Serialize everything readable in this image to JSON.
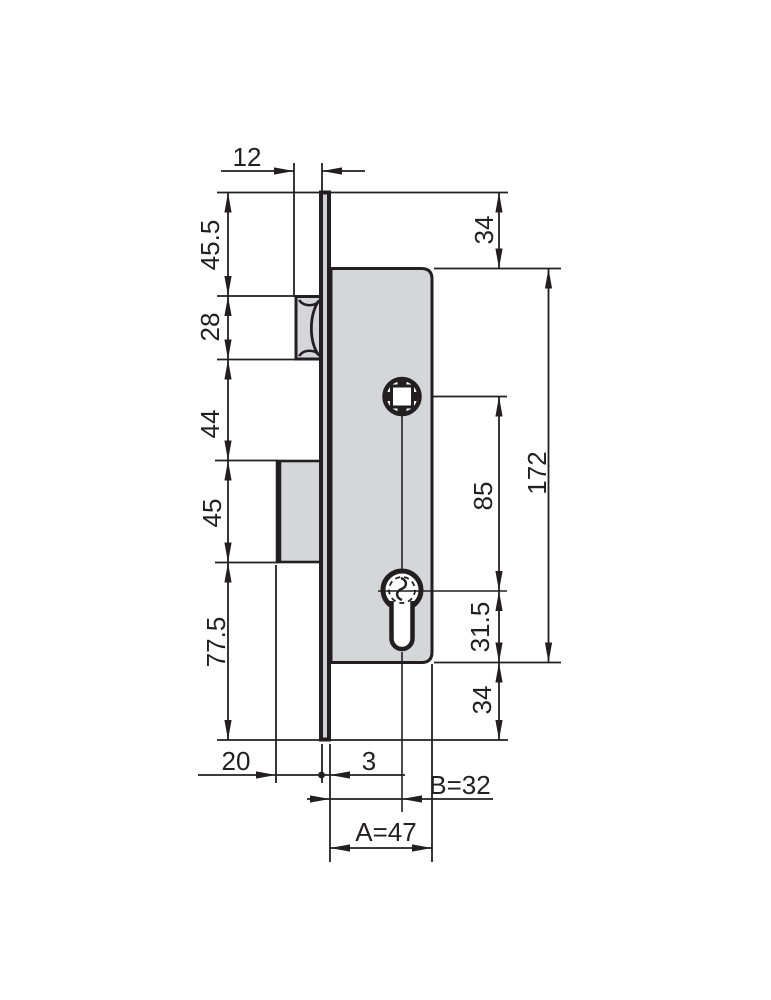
{
  "drawing": {
    "type": "technical-dimension-drawing",
    "subject": "mortise lock cross-section with roller latch and euro profile cylinder",
    "line_color": "#231f20",
    "part_fill": "#d5d6d8",
    "labels": {
      "roller_projection": "12",
      "top_to_roller": "45.5",
      "roller_height": "28",
      "roller_to_bolt": "44",
      "bolt_height": "45",
      "bolt_to_bottom": "77.5",
      "bolt_projection": "20",
      "faceplate_thickness": "3",
      "backset": "B=32",
      "case_depth": "A=47",
      "faceplate_top_to_case": "34",
      "spindle_to_cylinder": "85",
      "cylinder_to_case_bottom": "31.5",
      "case_bottom_to_faceplate_end": "34",
      "case_height": "172"
    }
  }
}
